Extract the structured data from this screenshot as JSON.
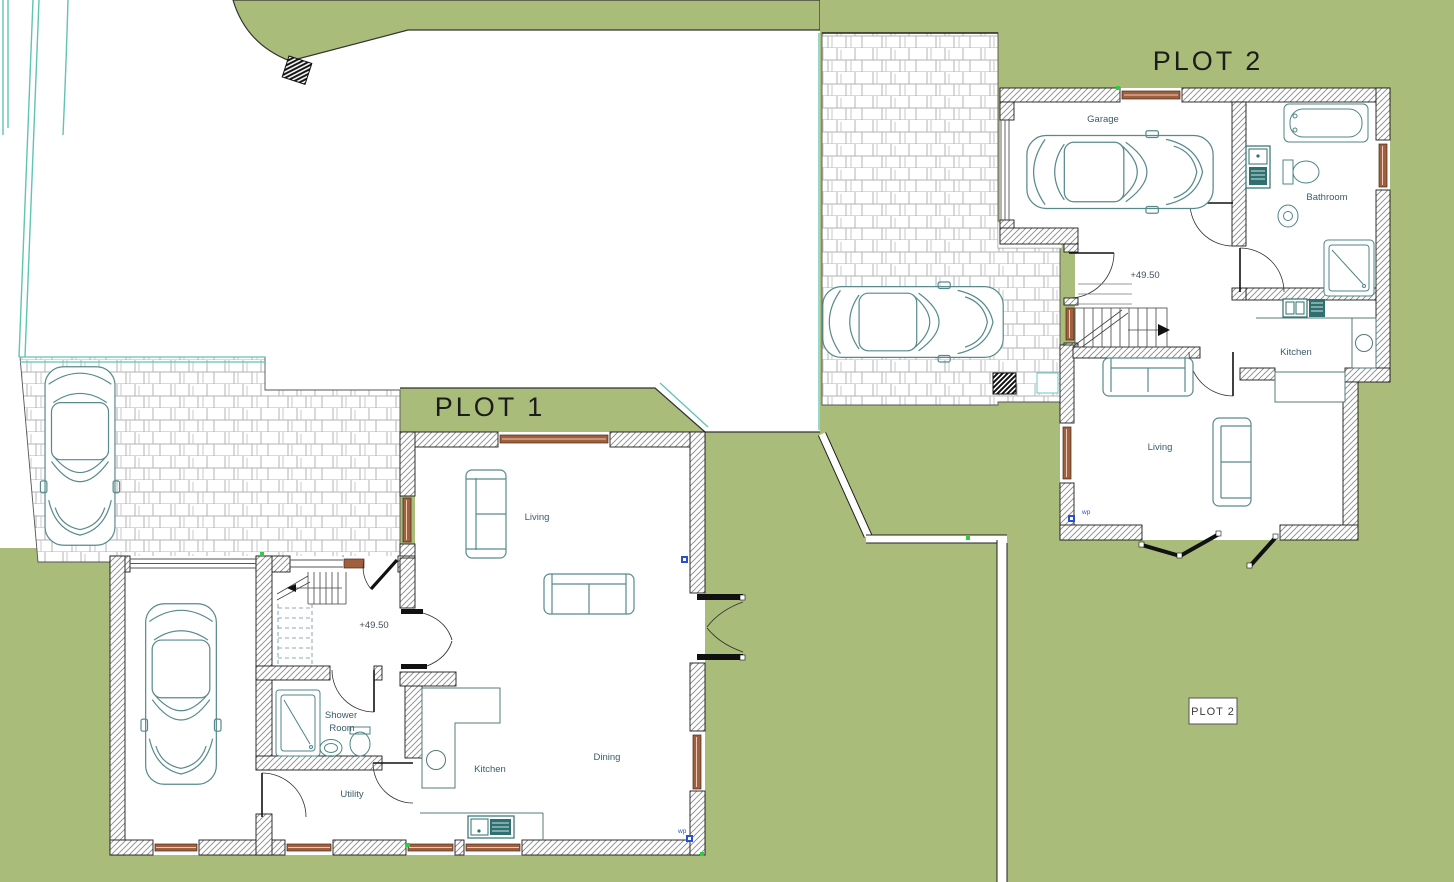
{
  "titles": {
    "plot1": "PLOT 1",
    "plot2": "PLOT 2",
    "plot2_box": "PLOT 2"
  },
  "plot1": {
    "level": "+49.50",
    "rooms": {
      "living": "Living",
      "kitchen": "Kitchen",
      "dining": "Dining",
      "utility": "Utility",
      "shower_line1": "Shower",
      "shower_line2": "Room"
    },
    "markers": {
      "wp": "wp"
    }
  },
  "plot2": {
    "level": "+49.50",
    "rooms": {
      "garage": "Garage",
      "bathroom": "Bathroom",
      "kitchen": "Kitchen",
      "living": "Living"
    },
    "markers": {
      "wp": "wp"
    }
  },
  "colors": {
    "lawn": "#a9bc7a",
    "brick_line": "#b3b3b3",
    "wall_hatch": "#8a8a8a",
    "outline": "#1a1a1a",
    "window_frame": "#a06040",
    "fixture_teal": "#4d8585",
    "fixture_dark": "#2f6f6f",
    "boundary_teal": "#5fc4b2",
    "wp_blue": "#2a4fd0",
    "survey_green": "#2ecc40",
    "label_blue": "#3a5c6b"
  }
}
